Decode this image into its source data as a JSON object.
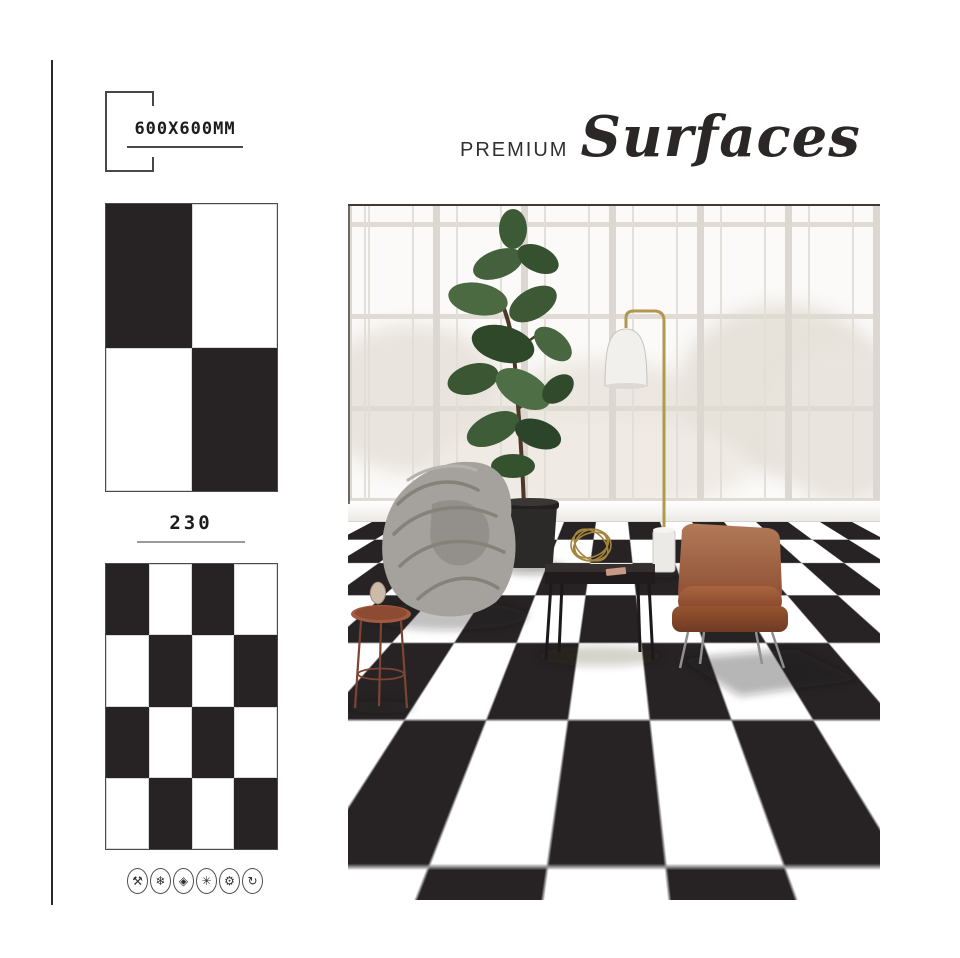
{
  "brand": {
    "prefix": "PREMIUM",
    "name": "Surfaces"
  },
  "product": {
    "size": "600X600MM",
    "code": "230"
  },
  "swatch_small": {
    "rows": 2,
    "cols": 2,
    "pattern": [
      [
        1,
        0
      ],
      [
        0,
        1
      ]
    ]
  },
  "swatch_large": {
    "rows": 4,
    "cols": 4,
    "pattern": [
      [
        1,
        0,
        1,
        0
      ],
      [
        0,
        1,
        0,
        1
      ],
      [
        1,
        0,
        1,
        0
      ],
      [
        0,
        1,
        0,
        1
      ]
    ]
  },
  "feature_icons": [
    {
      "name": "crossed-tools-icon",
      "glyph": "⚒"
    },
    {
      "name": "snowflake-icon",
      "glyph": "❄"
    },
    {
      "name": "diamond-icon",
      "glyph": "◈"
    },
    {
      "name": "asterisk-icon",
      "glyph": "✳"
    },
    {
      "name": "gear-icon",
      "glyph": "⚙"
    },
    {
      "name": "rotate-arrow-icon",
      "glyph": "↻"
    }
  ],
  "colors": {
    "tile_black": "#272324",
    "tile_white": "#ffffff",
    "leather_brown": "#8a4c30",
    "brass": "#b2974f",
    "copper_table": "#a25b41"
  }
}
